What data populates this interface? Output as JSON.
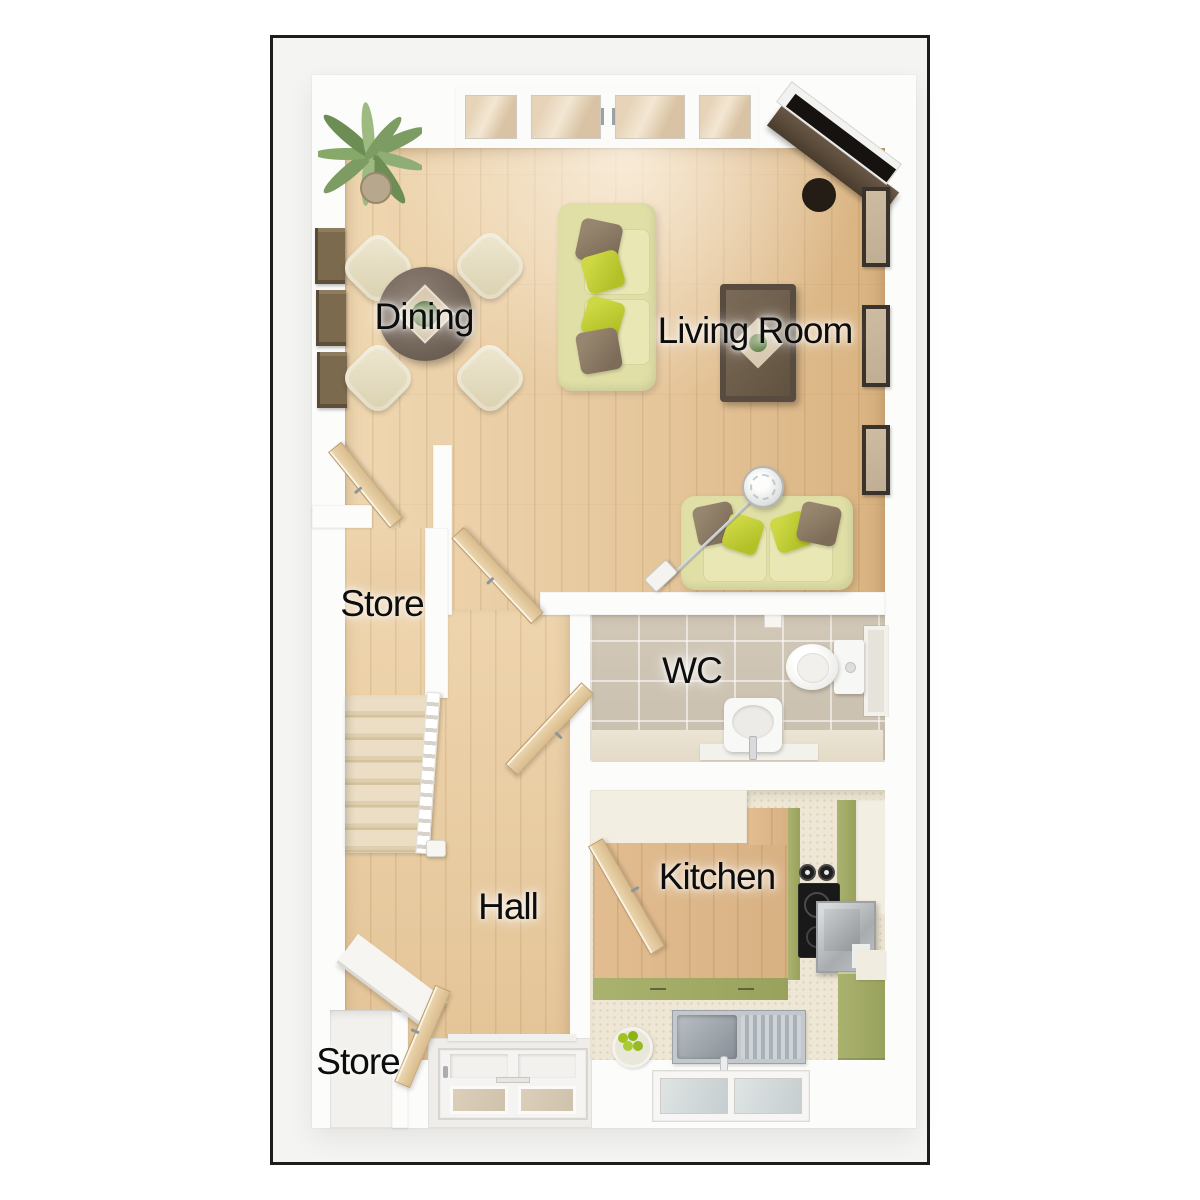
{
  "floor_plan": {
    "rooms": [
      {
        "id": "dining",
        "label": "Dining",
        "furniture": [
          "round-dining-table",
          "four-dining-chairs",
          "wall-shelves",
          "potted-plant"
        ]
      },
      {
        "id": "living-room",
        "label": "Living Room",
        "furniture": [
          "three-seat-sofa",
          "two-seat-sofa",
          "coffee-table",
          "tv-media-unit",
          "arc-floor-lamp",
          "picture-frames",
          "french-doors"
        ]
      },
      {
        "id": "store-upper",
        "label": "Store",
        "furniture": [
          "door"
        ]
      },
      {
        "id": "wc",
        "label": "WC",
        "furniture": [
          "toilet",
          "basin",
          "window",
          "door"
        ]
      },
      {
        "id": "hall",
        "label": "Hall",
        "furniture": [
          "staircase",
          "banister",
          "front-door"
        ]
      },
      {
        "id": "kitchen",
        "label": "Kitchen",
        "furniture": [
          "worktops",
          "sink-with-drainer",
          "hob-with-pans",
          "oven",
          "fruit-bowl",
          "window",
          "green-cabinets",
          "door"
        ]
      },
      {
        "id": "store-lower",
        "label": "Store",
        "furniture": [
          "door",
          "shelf"
        ]
      }
    ],
    "palette": {
      "frame_border": "#1d1d1d",
      "matte_background": "#f4f4f3",
      "wall_white": "#fcfcfb",
      "wood_floor_light": "#efd7b1",
      "wood_floor_dark": "#d9b280",
      "stair_carpet": "#ebdec4",
      "wc_tile": "#cdc3b2",
      "sofa_fabric": "#e0dfa6",
      "cushion_lime": "#c3cf33",
      "cushion_brown": "#8d7c67",
      "kitchen_unit_green": "#a3ab66",
      "kitchen_unit_cream": "#f2eee1",
      "table_wood_dark": "#6a5d52",
      "label_text": "#0d0d0d"
    }
  }
}
